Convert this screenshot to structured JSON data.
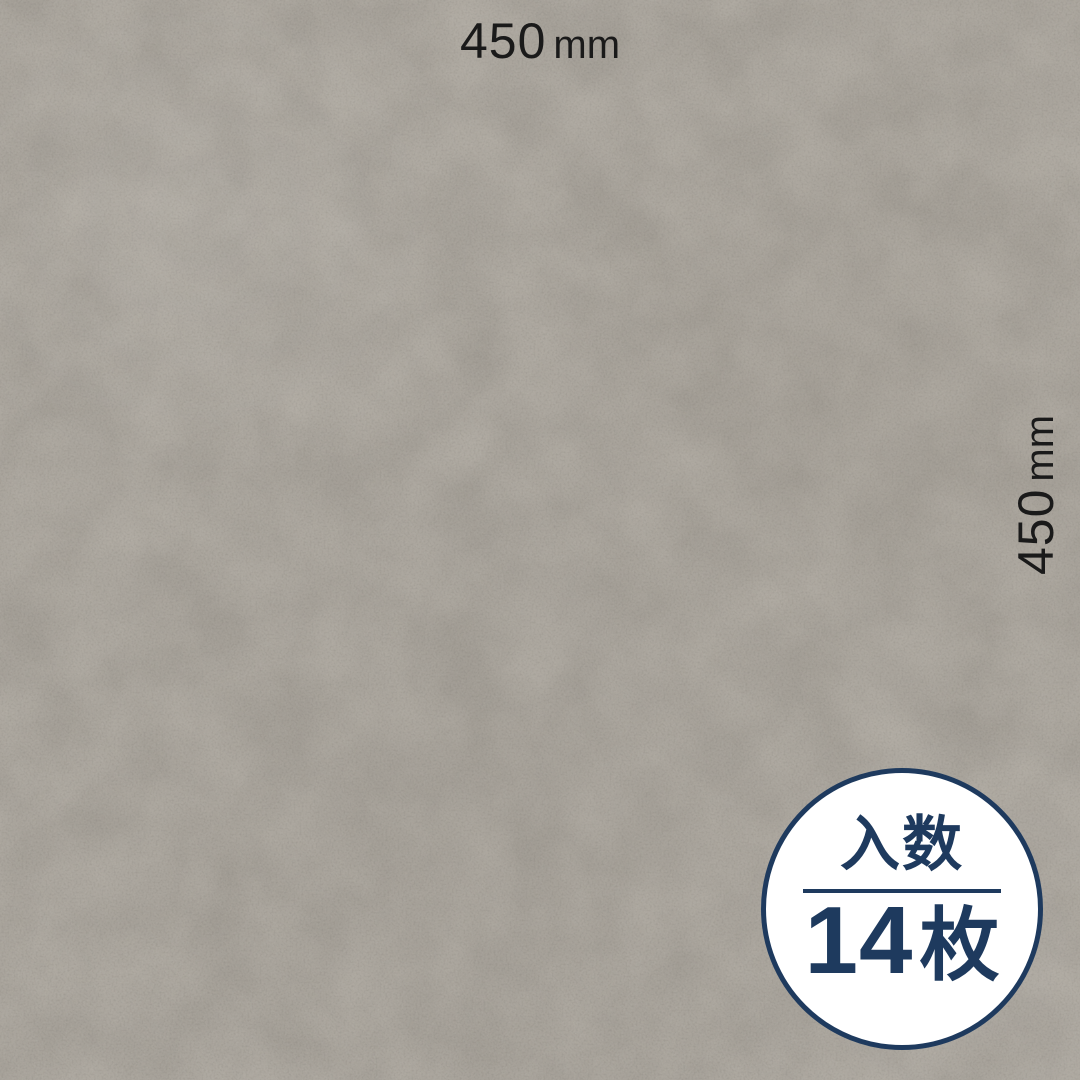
{
  "dimension_labels": {
    "top": {
      "value": "450",
      "unit": "mm"
    },
    "right": {
      "value": "450",
      "unit": "mm"
    }
  },
  "badge": {
    "title": "入数",
    "count": "14",
    "count_unit": "枚"
  },
  "colors": {
    "navy": "#1e3a5e",
    "texture_base": "#a9a49c",
    "dimension_text": "#1a1a1a",
    "badge_background": "#ffffff"
  }
}
